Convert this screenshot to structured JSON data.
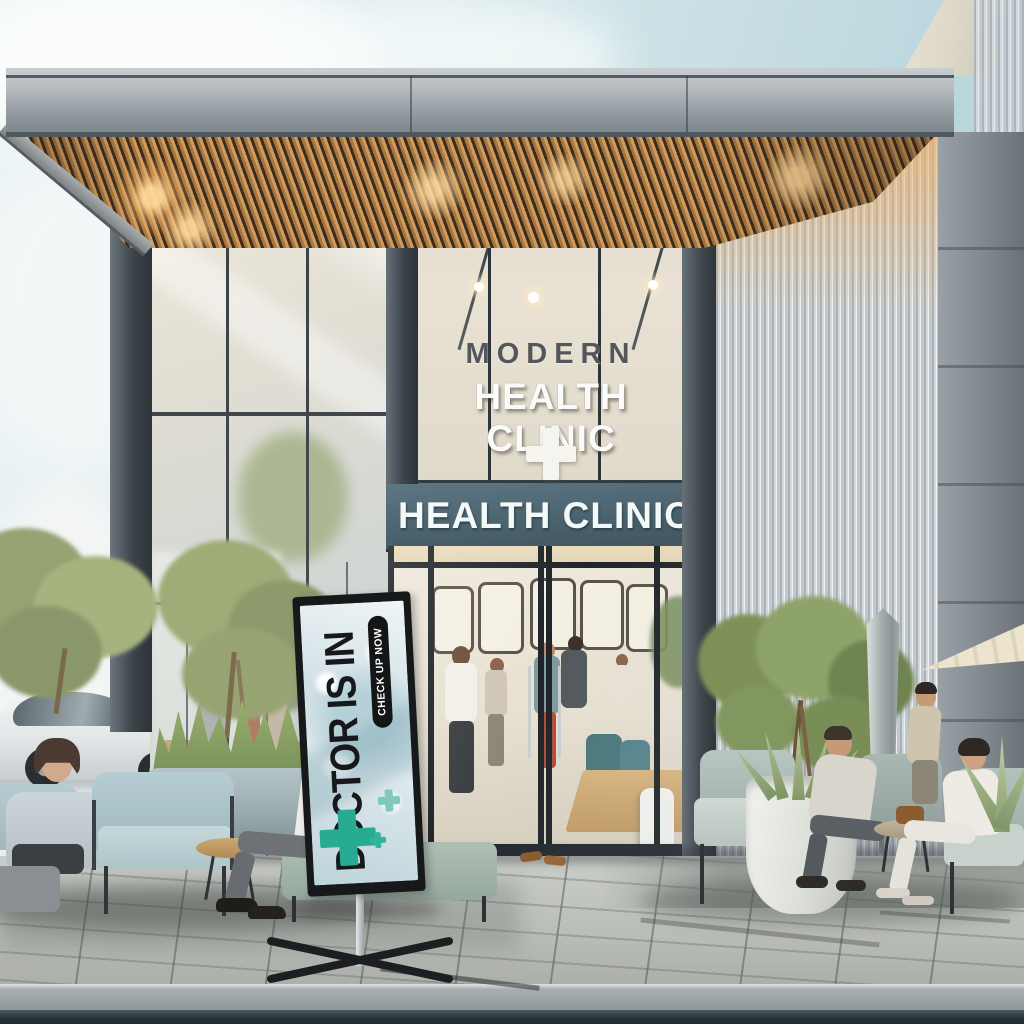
{
  "scene": {
    "name": "Modern health clinic storefront with outdoor seating",
    "interior_sign": {
      "line1": "MODERN",
      "line2": "HEALTH CLINIC"
    },
    "entrance_sign": {
      "text": "HEALTH CLINIC"
    },
    "banner": {
      "headline": "DOCTOR IS IN",
      "cta": "CHECK UP NOW"
    },
    "colors": {
      "sky": "#cfe3e9",
      "canopy_wood": "#b5824f",
      "sign_band": "#4b636f",
      "banner_cross_teal": "#27ab93",
      "cushion_blue": "#b8cfd4",
      "cushion_sage": "#aebfb8",
      "pavement": "#c2c4c0"
    }
  }
}
